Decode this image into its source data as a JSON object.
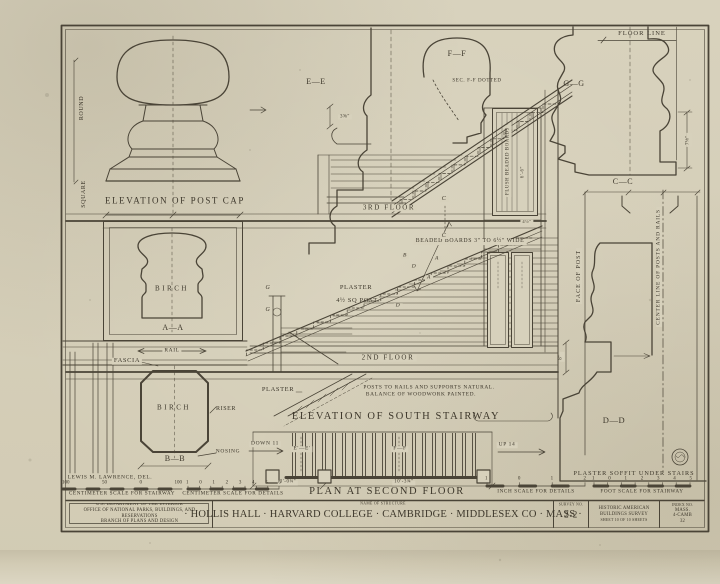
{
  "drawing": {
    "titles": {
      "post_cap": "ELEVATION OF POST CAP",
      "south_stairway": "ELEVATION OF SOUTH STAIRWAY",
      "plan": "PLAN AT SECOND FLOOR"
    },
    "labels": {
      "round": "ROUND",
      "square": "SQUARE",
      "birch": "BIRCH",
      "section_aa": "A—A",
      "rail": "RAIL",
      "fascia": "FASCIA",
      "riser": "RISER",
      "nosing": "NOSING",
      "section_bb": "B—B",
      "down_11": "DOWN 11",
      "up_14": "UP 14",
      "section_ee": "E—E",
      "section_ff": "F—F",
      "sec_ff_dotted": "SEC. F-F DOTTED",
      "section_gg": "G—G",
      "section_cc": "C—C",
      "section_dd": "D—D",
      "floor_line": "FLOOR LINE",
      "third_floor": "3RD FLOOR",
      "second_floor": "2ND FLOOR",
      "beaded_boards": "BEADED BOARDS 3\" TO 6½\" WIDE",
      "flush_beaded_boards": "FLUSH BEADED BOARDS",
      "plaster": "PLASTER",
      "sq_post": "4½ SQ POST",
      "face_of_post": "FACE OF POST",
      "center_line": "CENTER LINE OF POSTS AND RAILS",
      "plaster_soffit": "PLASTER SOFFIT UNDER STAIRS",
      "posts_note_1": "POSTS TO RAILS AND SUPPORTS NATURAL.",
      "posts_note_2": "BALANCE OF WOODWORK PAINTED.",
      "plan_ee": "E'—E'",
      "plan_ff": "F—F",
      "g": "G",
      "c": "C",
      "b": "B",
      "d": "D",
      "a": "A"
    },
    "dimensions": {
      "d_3_58": "3⅝\"",
      "d_7_18": "7⅛\"",
      "d_8": "8\"",
      "d_6_6": "6'-6\"",
      "d_4_12": "4½\"",
      "d_3_0": "3'-0¼\"",
      "d_10_3": "10'-3¾\""
    },
    "credit": "LEWIS M. LAWRENCE, DEL.",
    "scales": {
      "cm_stairway_numbers": [
        "100",
        "50",
        "0",
        "100"
      ],
      "cm_details_numbers": [
        "1",
        "0",
        "1",
        "2",
        "3",
        "4",
        "5",
        "6"
      ],
      "inch_numbers": [
        "1",
        "0",
        "1",
        "2"
      ],
      "foot_numbers": [
        "1",
        "0",
        "1",
        "2",
        "3",
        "4",
        "5"
      ],
      "cm_stairway_label": "CENTIMETER SCALE FOR STAIRWAY",
      "cm_details_label": "CENTIMETER SCALE FOR DETAILS",
      "inch_label": "INCH SCALE FOR DETAILS",
      "foot_label": "FOOT SCALE FOR STAIRWAY"
    }
  },
  "title_block": {
    "agency_line1": "U.S. DEPARTMENT OF THE INTERIOR",
    "agency_line2": "OFFICE OF NATIONAL PARKS, BUILDINGS, AND RESERVATIONS",
    "agency_line3": "BRANCH OF PLANS AND DESIGN",
    "name_of_structure_label": "NAME OF STRUCTURE",
    "structure_name": "· HOLLIS HALL · HARVARD COLLEGE · CAMBRIDGE · MIDDLESEX CO · MASS ·",
    "survey_label": "SURVEY NO.",
    "survey_no": "2-2",
    "habs_line1": "HISTORIC AMERICAN",
    "habs_line2": "BUILDINGS SURVEY",
    "habs_line3": "SHEET 10 OF 10 SHEETS",
    "index_label": "INDEX NO.",
    "index_line1": "MASS.",
    "index_line2": "4-CAMB",
    "index_line3": "32"
  },
  "colors": {
    "paper": "#d7d1bc",
    "ink": "#4a4437"
  }
}
